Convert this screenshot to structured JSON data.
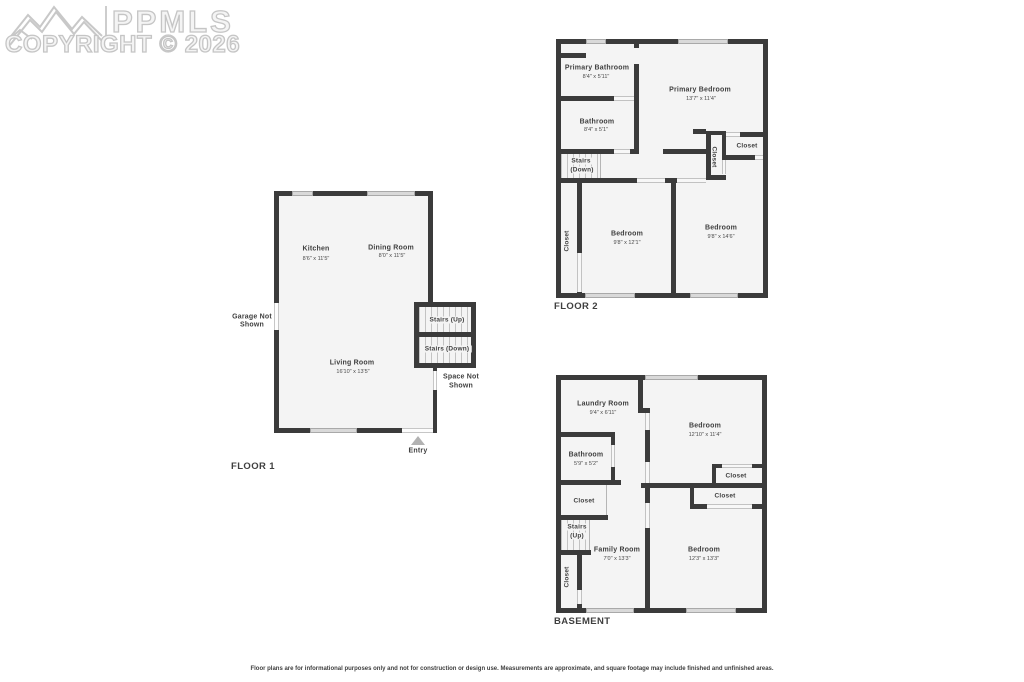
{
  "watermark": {
    "brand": "PPMLS",
    "copyright": "COPYRIGHT © 2026"
  },
  "floor1": {
    "label": "FLOOR 1",
    "kitchen": {
      "name": "Kitchen",
      "dims": "8'6\" x 11'5\""
    },
    "dining": {
      "name": "Dining Room",
      "dims": "8'0\" x 11'5\""
    },
    "living": {
      "name": "Living Room",
      "dims": "16'10\" x 13'5\""
    },
    "stairs_up": "Stairs (Up)",
    "stairs_down": "Stairs (Down)",
    "garage_note": {
      "line1": "Garage Not",
      "line2": "Shown"
    },
    "space_note": {
      "line1": "Space Not",
      "line2": "Shown"
    },
    "entry": "Entry"
  },
  "floor2": {
    "label": "FLOOR 2",
    "primary_bathroom": {
      "name": "Primary Bathroom",
      "dims": "8'4\" x 5'11\""
    },
    "primary_bedroom": {
      "name": "Primary Bedroom",
      "dims": "13'7\" x 11'4\""
    },
    "bathroom": {
      "name": "Bathroom",
      "dims": "8'4\" x 5'1\""
    },
    "stairs": {
      "line1": "Stairs",
      "line2": "(Down)"
    },
    "bedroom_left": {
      "name": "Bedroom",
      "dims": "9'8\" x 12'1\""
    },
    "bedroom_right": {
      "name": "Bedroom",
      "dims": "9'8\" x 14'6\""
    },
    "closet_hall": "Closet",
    "closet_right": "Closet",
    "closet_left": "Closet"
  },
  "basement": {
    "label": "BASEMENT",
    "laundry": {
      "name": "Laundry Room",
      "dims": "9'4\" x 6'11\""
    },
    "bedroom_top": {
      "name": "Bedroom",
      "dims": "12'10\" x 11'4\""
    },
    "bathroom": {
      "name": "Bathroom",
      "dims": "5'9\" x 5'2\""
    },
    "closet_left": "Closet",
    "closet_right_upper": "Closet",
    "closet_right_lower": "Closet",
    "closet_bottom_left": "Closet",
    "stairs": {
      "line1": "Stairs",
      "line2": "(Up)"
    },
    "family": {
      "name": "Family Room",
      "dims": "7'0\" x 13'3\""
    },
    "bedroom_bottom": {
      "name": "Bedroom",
      "dims": "12'3\" x 13'3\""
    }
  },
  "disclaimer": "Floor plans are for informational purposes only and not for construction or design use. Measurements are approximate, and square footage may include finished and unfinished areas."
}
